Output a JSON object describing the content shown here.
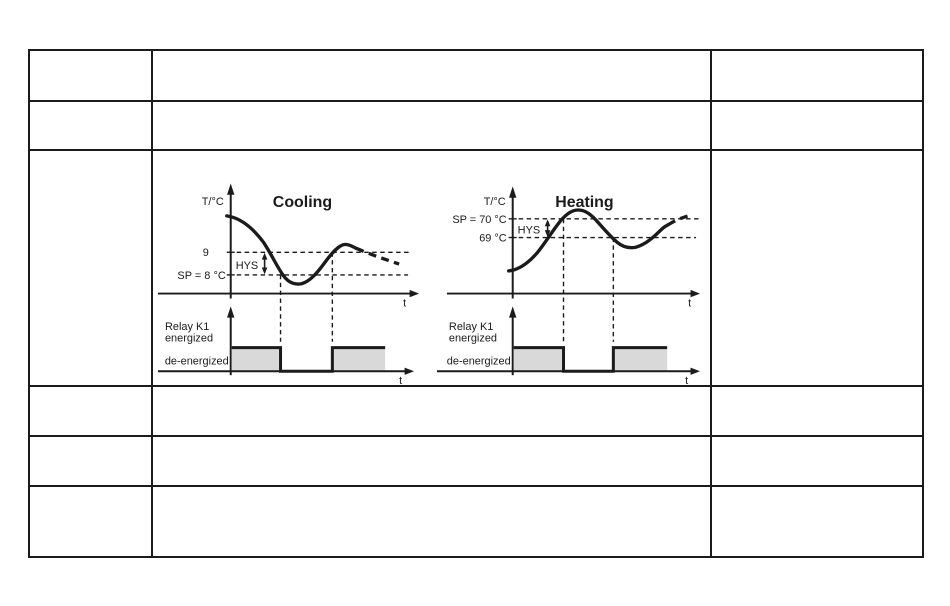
{
  "colors": {
    "line": "#1b1b1b",
    "relay_fill": "#d9d9d9",
    "table_border": "#1b1b1b"
  },
  "diagrams": {
    "cooling": {
      "title": "Cooling",
      "y_axis_label": "T/°C",
      "x_axis_label": "t",
      "threshold_label": "9",
      "setpoint_label": "SP = 8 °C",
      "hys_label": "HYS",
      "relay_label_line1": "Relay K1",
      "relay_label_line2": "energized",
      "relay_label_line3": "de-energized",
      "relay_x_axis_label": "t"
    },
    "heating": {
      "title": "Heating",
      "y_axis_label": "T/°C",
      "x_axis_label": "t",
      "setpoint_label": "SP = 70 °C",
      "threshold_label": "69 °C",
      "hys_label": "HYS",
      "relay_label_line1": "Relay K1",
      "relay_label_line2": "energized",
      "relay_label_line3": "de-energized",
      "relay_x_axis_label": "t"
    }
  },
  "chart_data": [
    {
      "type": "line",
      "title": "Cooling",
      "xlabel": "t",
      "ylabel": "T/°C",
      "setpoint_c": 8,
      "switch_threshold_c": 9,
      "hysteresis_c": 1,
      "annotations": [
        "9",
        "SP = 8 °C",
        "HYS"
      ],
      "relay_name": "Relay K1",
      "relay_states_sequence": [
        "energized",
        "de-energized",
        "energized"
      ],
      "relay_axis_labels": [
        "Relay K1",
        "energized",
        "de-energized"
      ],
      "curve_shape": "temperature starts above 9, falls below SP = 8 °C, rises back above 9, then slowly falls (dashed continuation)"
    },
    {
      "type": "line",
      "title": "Heating",
      "xlabel": "t",
      "ylabel": "T/°C",
      "setpoint_c": 70,
      "switch_threshold_c": 69,
      "hysteresis_c": 1,
      "annotations": [
        "SP = 70 °C",
        "69 °C",
        "HYS"
      ],
      "relay_name": "Relay K1",
      "relay_states_sequence": [
        "energized",
        "de-energized",
        "energized"
      ],
      "relay_axis_labels": [
        "Relay K1",
        "energized",
        "de-energized"
      ],
      "curve_shape": "temperature starts low, rises above SP = 70 °C, falls below 69 °C, rises again (dashed continuation)"
    }
  ]
}
